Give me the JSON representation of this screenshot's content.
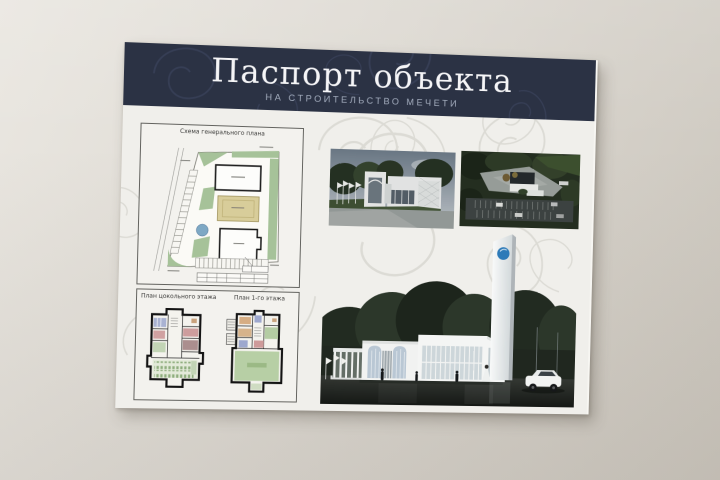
{
  "board": {
    "header": {
      "title": "Паспорт объекта",
      "subtitle": "НА СТРОИТЕЛЬСТВО МЕЧЕТИ"
    },
    "site_plan": {
      "title": "Схема генерального плана"
    },
    "floor_plans": {
      "basement_title": "План цокольного этажа",
      "first_floor_title": "План 1-го этажа"
    },
    "colors": {
      "header_bg": "#2b3244",
      "header_title": "#f5f5f7",
      "header_subtitle": "#a2abbc",
      "board_bg": "#f0efeb",
      "ornament": "#dcdbd5",
      "wall": "#d9d5cd",
      "plan_green": "#a6c299",
      "plan_tan": "#d8cd9a",
      "plan_pond_blue": "#7ea8c4",
      "minaret_emblem_blue": "#2d7ab8",
      "tree_dark_green": "#222b21"
    }
  }
}
